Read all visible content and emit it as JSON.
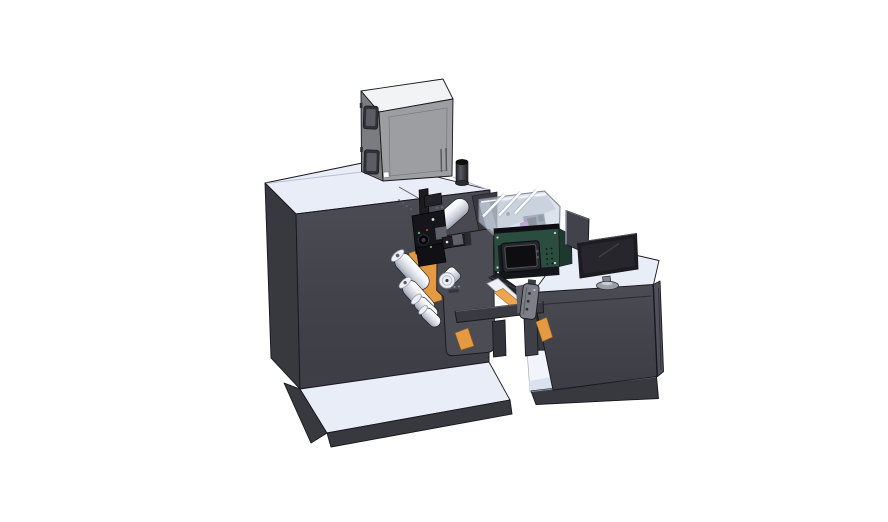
{
  "scene": {
    "title": "3D CAD render of a label printing machine line",
    "view": "isometric"
  },
  "palette": {
    "bg": "#ffffff",
    "light_top": "#e9edf8",
    "light_top_2": "#e2e8f5",
    "dark_face": "#46464f",
    "dark_face_2": "#38383f",
    "dark_face_3": "#50505a",
    "edge": "#17171c",
    "box_top": "#f2f3f5",
    "box_front": "#9d9ea1",
    "box_left": "#7b7c80",
    "window_dark": "#303036",
    "window_mid": "#5b5c64",
    "orange": "#eda64f",
    "orange_2": "#e39a42",
    "green_face": "#2b4d40",
    "green_side": "#1d392f",
    "screen_dark": "#0e0e11",
    "screen_frame": "#26272c",
    "cover_fill": "#c7d2e0",
    "cover_edge": "#79828f",
    "magenta": "#c45ecd",
    "monitor_frame": "#1c1c21",
    "monitor_screen": "#26262c",
    "stand_gray": "#9aa0ab",
    "handle_gray": "#7e7e86",
    "roller_cap": "#edf0f6",
    "interior_white": "#f1f4fa",
    "beam_dark": "#3a3a42"
  },
  "components": {
    "viewport": "CAD model viewport",
    "machine": "Unwinder cabinet",
    "machine_base": "Machine base plate",
    "cabinet": "Electrical control box",
    "cabinet_window_1": "Inspection window",
    "cabinet_window_2": "Inspection window",
    "cylinder": "Exhaust stack",
    "recess": "Web exit recess",
    "orange_plates": "Orange web guide plates",
    "rollers": "Web guide rollers",
    "plate": "Dancer arm plate",
    "mechanism": "Print head assembly",
    "cover": "Transparent safety cover",
    "inkjet": "Inkjet module",
    "inkjet_screen": "Control touchscreen",
    "web_path": "Web path to rewinder",
    "beam": "Connecting frame",
    "handle": "Tension lever",
    "desk": "Operator desk",
    "desk_cubby": "Desk shelf opening",
    "desk_base": "Desk base plate",
    "panel": "Side display panel",
    "monitor": "Desktop monitor",
    "monitor_stand": "Monitor stand"
  }
}
